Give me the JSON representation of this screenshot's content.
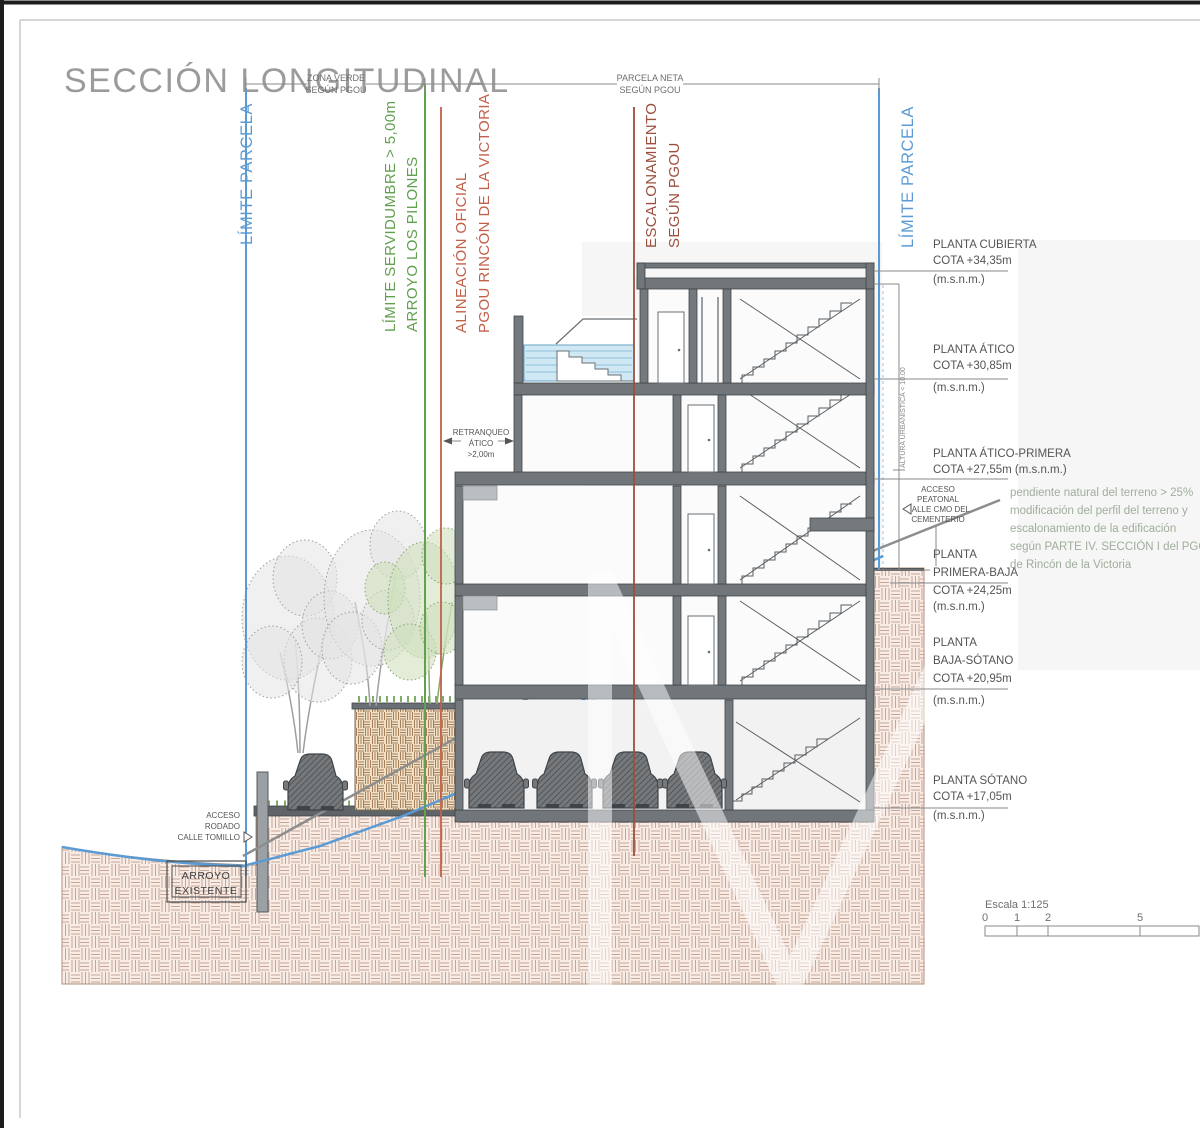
{
  "title": "SECCIÓN LONGITUDINAL",
  "colors": {
    "parcel_blue": "#5b9bd5",
    "servidumbre_green": "#61a04f",
    "alineacion_orange": "#c2604a",
    "escalonamiento_brown": "#9c4f3e",
    "annotation_green": "#9fae9b",
    "ground_hatch": "#c9a493",
    "ink": "#4a4a4a"
  },
  "top_dimensions": {
    "zona_verde_line1": "ZONA VERDE",
    "zona_verde_line2": "SEGÚN PGOU",
    "parcela_neta_line1": "PARCELA NETA",
    "parcela_neta_line2": "SEGÚN PGOU"
  },
  "boundaries": {
    "limite_parcela_left": "LÍMITE PARCELA",
    "servidumbre_line1": "LÍMITE SERVIDUMBRE > 5,00m",
    "servidumbre_line2": "ARROYO LOS PILONES",
    "alineacion_line1": "ALINEACIÓN OFICIAL",
    "alineacion_line2": "PGOU RINCÓN DE LA VICTORIA",
    "escalonamiento_line1": "ESCALONAMIENTO",
    "escalonamiento_line2": "SEGÚN PGOU",
    "limite_parcela_right": "LÍMITE PARCELA",
    "altura_urbanistica": "ALTURA URBANÍSTICA < 10.00"
  },
  "levels": [
    {
      "name": "PLANTA CUBIERTA",
      "cota": "COTA +34,35m",
      "msnm": "(m.s.n.m.)"
    },
    {
      "name": "PLANTA ÁTICO",
      "cota": "COTA +30,85m",
      "msnm": "(m.s.n.m.)"
    },
    {
      "name": "PLANTA ÁTICO-PRIMERA",
      "cota": "COTA +27,55m (m.s.n.m.)"
    },
    {
      "name": "PLANTA",
      "name2": "PRIMERA-BAJA",
      "cota": "COTA +24,25m",
      "msnm": "(m.s.n.m.)"
    },
    {
      "name": "PLANTA",
      "name2": "BAJA-SÓTANO",
      "cota": "COTA +20,95m",
      "msnm": "(m.s.n.m.)"
    },
    {
      "name": "PLANTA SÓTANO",
      "cota": "COTA +17,05m",
      "msnm": "(m.s.n.m.)"
    }
  ],
  "annotations": {
    "retranqueo_line1": "RETRANQUEO",
    "retranqueo_line2": "ÁTICO",
    "retranqueo_line3": ">2,00m",
    "acceso_peatonal_line1": "ACCESO",
    "acceso_peatonal_line2": "PEATONAL",
    "acceso_peatonal_line3": "CALLE CMO DEL",
    "acceso_peatonal_line4": "CEMENTERIO",
    "acceso_rodado_line1": "ACCESO",
    "acceso_rodado_line2": "RODADO",
    "acceso_rodado_line3": "CALLE TOMILLO",
    "arroyo_existente_line1": "ARROYO",
    "arroyo_existente_line2": "EXISTENTE",
    "arroyo_entubado": "arroyo entubado",
    "pendiente_line1": "pendiente natural  del terreno > 25%",
    "pendiente_line2": "modificación del perfil del terreno y",
    "pendiente_line3": "escalonamiento de la edificación",
    "pendiente_line4": "según PARTE IV. SECCIÓN I del PGOU",
    "pendiente_line5": "de Rincón de la Victoria"
  },
  "scale_bar": {
    "label": "Escala 1:125",
    "tick0": "0",
    "tick1": "1",
    "tick2": "2",
    "tick5": "5"
  }
}
